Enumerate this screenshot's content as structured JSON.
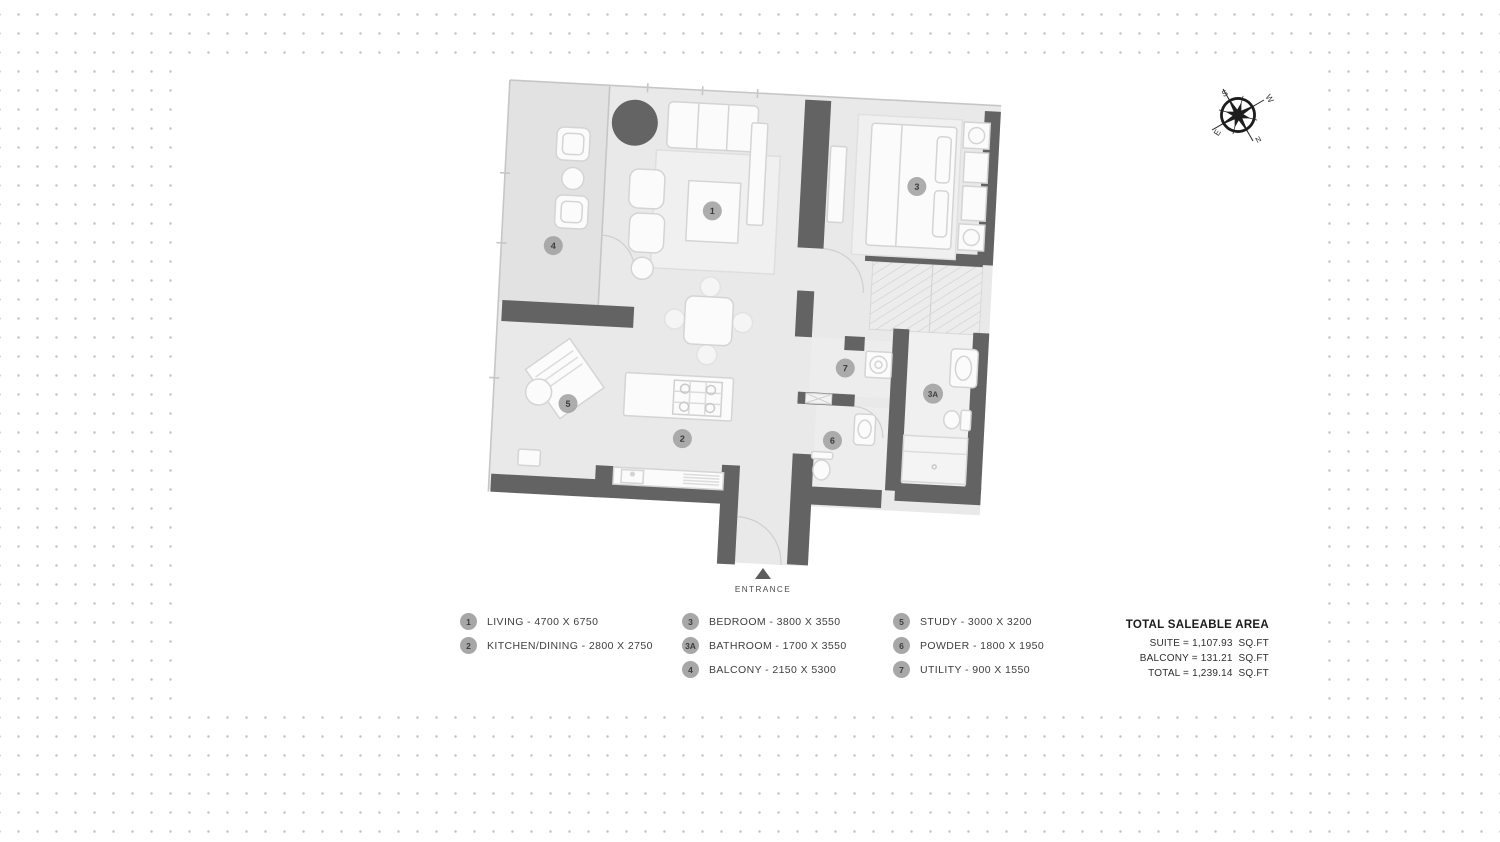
{
  "colors": {
    "wall": "#636363",
    "floor": "#e9e9e9",
    "balcony_floor": "#e2e2e2",
    "dot": "#c7c7c7",
    "badge_bg": "#a0a0a0"
  },
  "compass": {
    "n": "N",
    "s": "S",
    "e": "E",
    "w": "W"
  },
  "entrance": {
    "label": "ENTRANCE"
  },
  "floorplan": {
    "badges": [
      "1",
      "2",
      "3",
      "3A",
      "4",
      "5",
      "6",
      "7"
    ]
  },
  "legend": {
    "columns": [
      {
        "items": [
          {
            "badge": "1",
            "label": "LIVING - 4700 X 6750"
          },
          {
            "badge": "2",
            "label": "KITCHEN/DINING - 2800 X 2750"
          }
        ]
      },
      {
        "items": [
          {
            "badge": "3",
            "label": "BEDROOM - 3800 X 3550"
          },
          {
            "badge": "3A",
            "label": "BATHROOM - 1700 X 3550"
          },
          {
            "badge": "4",
            "label": "BALCONY - 2150 X 5300"
          }
        ]
      },
      {
        "items": [
          {
            "badge": "5",
            "label": "STUDY - 3000 X 3200"
          },
          {
            "badge": "6",
            "label": "POWDER - 1800 X 1950"
          },
          {
            "badge": "7",
            "label": "UTILITY - 900 X 1550"
          }
        ]
      }
    ]
  },
  "totals": {
    "title": "TOTAL SALEABLE AREA",
    "lines": [
      "SUITE = 1,107.93  SQ.FT",
      "BALCONY = 131.21  SQ.FT",
      "TOTAL = 1,239.14  SQ.FT"
    ]
  }
}
